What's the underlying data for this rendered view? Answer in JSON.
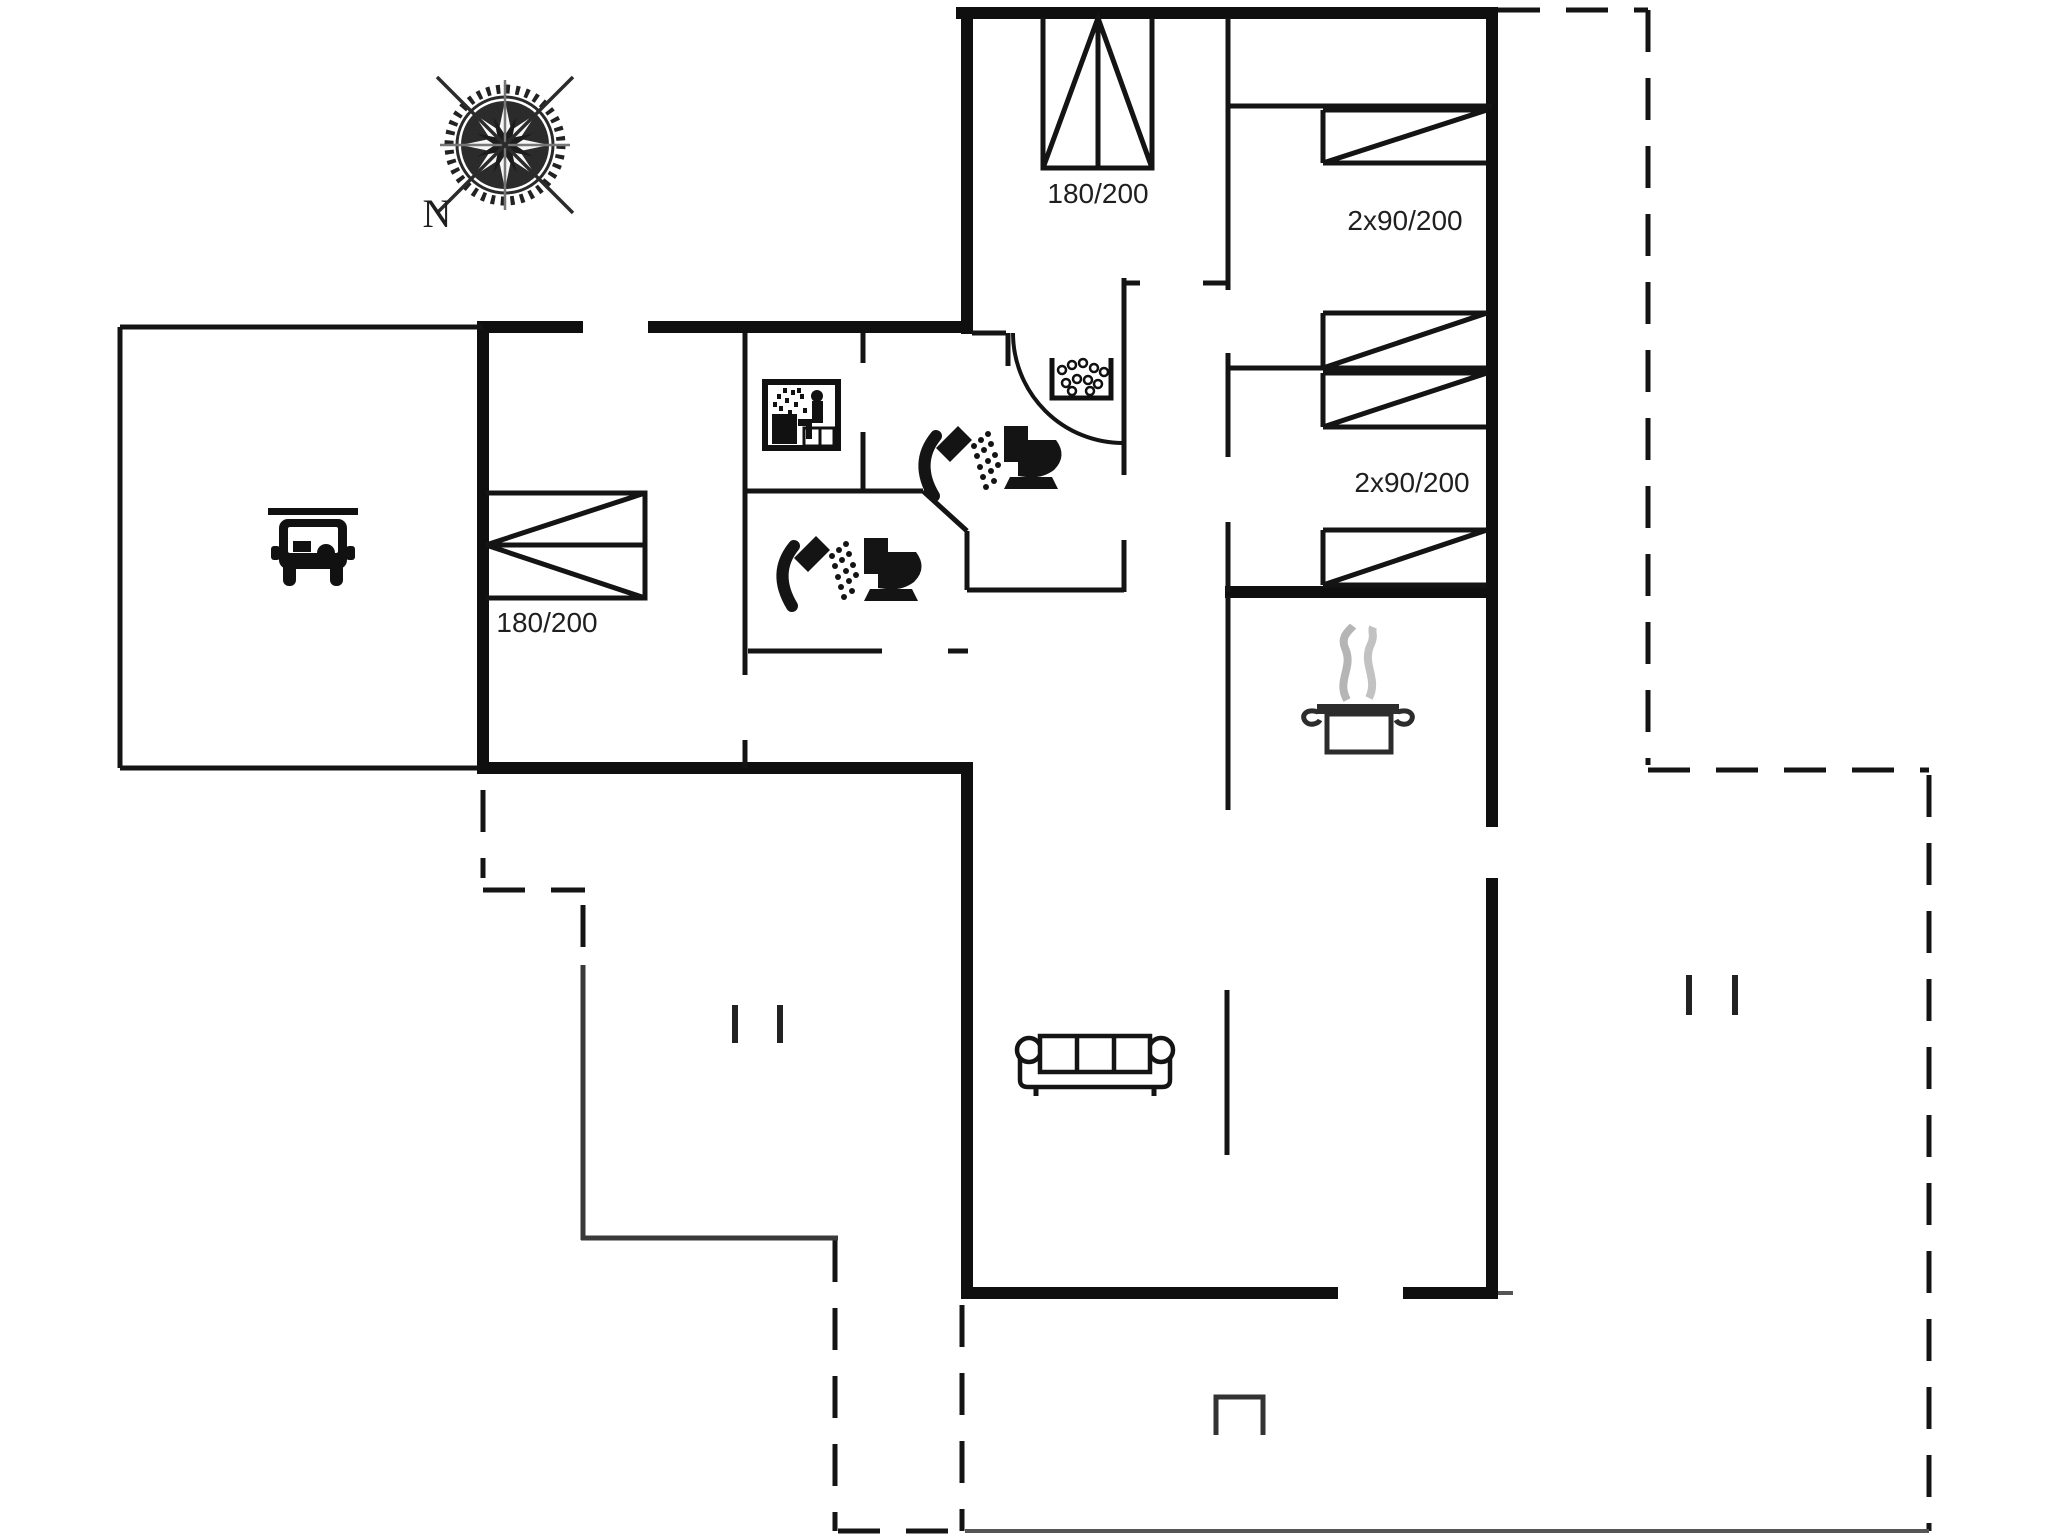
{
  "compass": {
    "label": "N"
  },
  "labels": {
    "bed_top": "180/200",
    "bed_left": "180/200",
    "bedroom_right_top": "2x90/200",
    "bedroom_right_mid": "2x90/200"
  },
  "icons": [
    {
      "name": "compass-rose-icon"
    },
    {
      "name": "car-icon"
    },
    {
      "name": "sauna-icon"
    },
    {
      "name": "whirlpool-icon"
    },
    {
      "name": "shower-icon-upper"
    },
    {
      "name": "toilet-icon-upper"
    },
    {
      "name": "shower-icon-lower"
    },
    {
      "name": "toilet-icon-lower"
    },
    {
      "name": "cooking-pot-icon"
    },
    {
      "name": "sofa-icon"
    },
    {
      "name": "door-arc"
    },
    {
      "name": "double-bed-symbol"
    },
    {
      "name": "single-bed-symbols"
    }
  ],
  "colors": {
    "background": "#ffffff",
    "wall": "#0f0f0f",
    "thin_line": "#141414",
    "gray_line": "#555555",
    "steam": "#b5b5b5"
  }
}
